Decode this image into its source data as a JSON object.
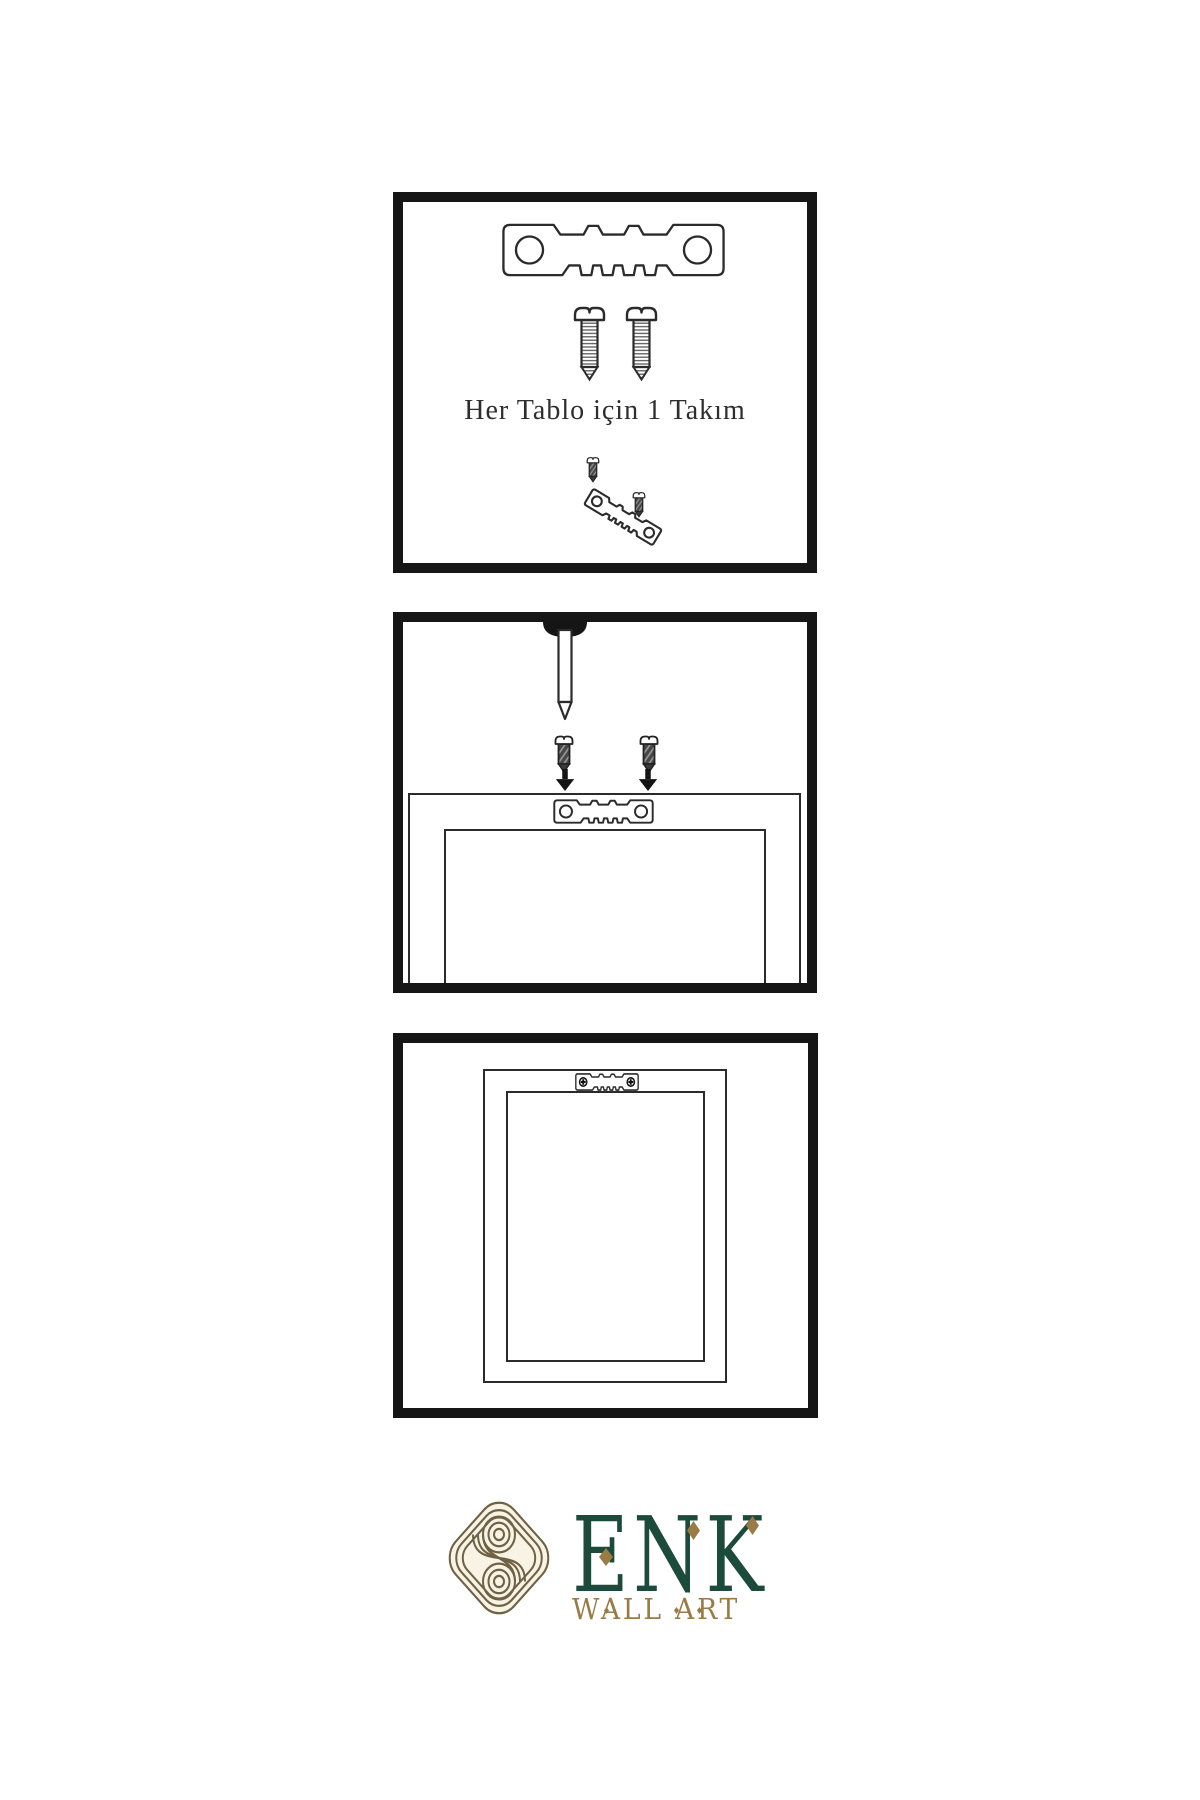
{
  "page": {
    "background": "#ffffff"
  },
  "panels": {
    "kit": {
      "caption": "Her Tablo için 1 Takım",
      "contents": [
        "sawtooth-hanger-icon",
        "screw-icon",
        "screw-icon",
        "tilted-hanger-assembly-icon"
      ]
    },
    "wall_nail": {
      "contents": [
        "nail-in-wall-icon",
        "dark-screw-icon",
        "dark-screw-icon",
        "arrow-down-icon",
        "arrow-down-icon",
        "frame-back-with-hanger"
      ]
    },
    "hung_frame": {
      "contents": [
        "frame-back-with-installed-hanger",
        "crosshead-screw-icon",
        "crosshead-screw-icon"
      ]
    }
  },
  "logo": {
    "name": "ENK",
    "subtitle": "WALL ART"
  },
  "colors": {
    "panel_border": "#161616",
    "line_ink": "#2b2b2b",
    "screw_dark_fill": "#474747",
    "brand_green": "#1d4b3b",
    "brand_gold": "#9a7b45",
    "knot_line": "#6f6244",
    "knot_fill": "#f8f3e4"
  }
}
